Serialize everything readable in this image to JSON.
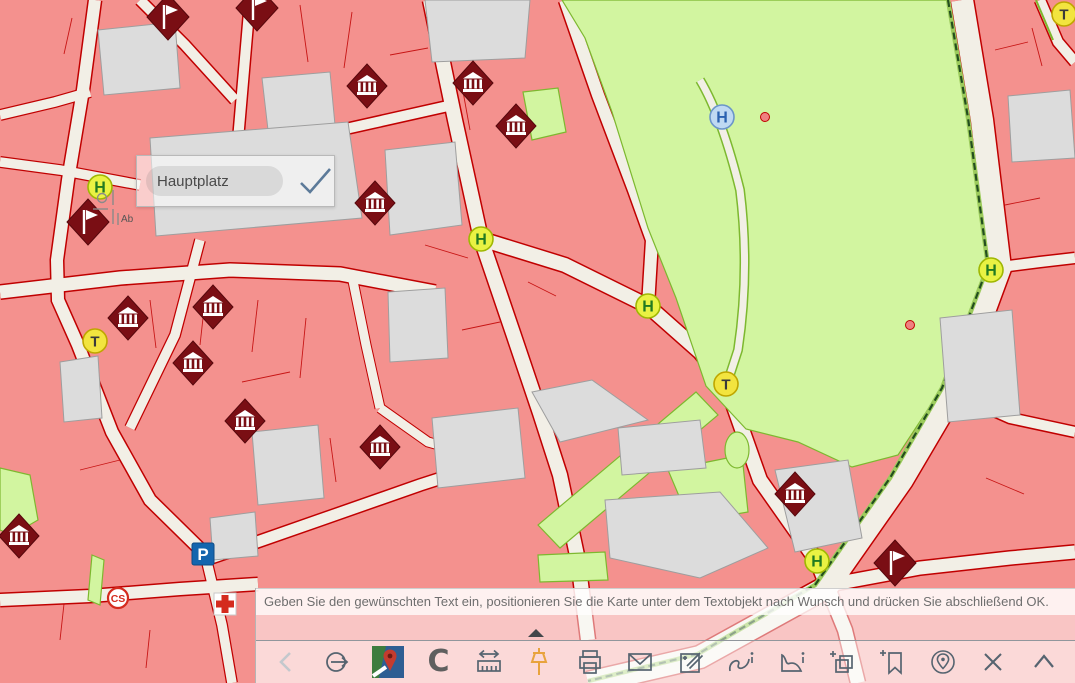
{
  "app": {
    "kind": "GIS map viewer with text annotation tool"
  },
  "text_overlay": {
    "value": "Hauptplatz",
    "confirm_icon": "check"
  },
  "message_bar": {
    "text": "Geben Sie den gewünschten Text ein, positionieren Sie die Karte unter dem Textobjekt nach Wunsch und drücken Sie abschließend OK."
  },
  "toolbar": {
    "items": [
      {
        "name": "back",
        "icon": "chevron-left",
        "label": ""
      },
      {
        "name": "sign-out",
        "icon": "arrow-circle",
        "label": ""
      },
      {
        "name": "basemap",
        "icon": "map-thumbnail",
        "label": ""
      },
      {
        "name": "copyright",
        "icon": "letter",
        "label": "C"
      },
      {
        "name": "measure",
        "icon": "ruler-arrows",
        "label": ""
      },
      {
        "name": "pin",
        "icon": "pushpin",
        "label": ""
      },
      {
        "name": "print",
        "icon": "printer",
        "label": ""
      },
      {
        "name": "email",
        "icon": "envelope",
        "label": ""
      },
      {
        "name": "edit",
        "icon": "edit-square",
        "label": ""
      },
      {
        "name": "line-info",
        "icon": "curve-info",
        "label": ""
      },
      {
        "name": "area-info",
        "icon": "polygon-info",
        "label": ""
      },
      {
        "name": "add-layers",
        "icon": "layers-plus",
        "label": ""
      },
      {
        "name": "add-bookmark",
        "icon": "bookmark-plus",
        "label": ""
      },
      {
        "name": "locate",
        "icon": "globe-pin",
        "label": ""
      },
      {
        "name": "close",
        "icon": "x",
        "label": ""
      },
      {
        "name": "collapse",
        "icon": "chevron-up",
        "label": ""
      }
    ]
  },
  "map": {
    "colors": {
      "street": "#F2EFE6",
      "building": "#F4918E",
      "building_border": "#C00000",
      "gray_building": "#DCDCDC",
      "park": "#D2F5A0",
      "park_border": "#7DB82F",
      "boundary_dash": "#234F1E",
      "marker_dark_red": "#7A0E14",
      "stop_yellow": "#E9F243",
      "taxi_yellow": "#F2E43F",
      "parking_blue": "#1465AE",
      "cross_red": "#D42B1E"
    },
    "markers": [
      {
        "type": "flag",
        "x": 168,
        "y": 17
      },
      {
        "type": "flag",
        "x": 257,
        "y": 8
      },
      {
        "type": "flag",
        "x": 88,
        "y": 222
      },
      {
        "type": "flag",
        "x": 895,
        "y": 563
      },
      {
        "type": "museum",
        "x": 367,
        "y": 86
      },
      {
        "type": "museum",
        "x": 473,
        "y": 83
      },
      {
        "type": "museum",
        "x": 516,
        "y": 126
      },
      {
        "type": "museum",
        "x": 375,
        "y": 203
      },
      {
        "type": "museum",
        "x": 128,
        "y": 318
      },
      {
        "type": "museum",
        "x": 213,
        "y": 307
      },
      {
        "type": "museum",
        "x": 193,
        "y": 363
      },
      {
        "type": "museum",
        "x": 245,
        "y": 421
      },
      {
        "type": "museum",
        "x": 380,
        "y": 447
      },
      {
        "type": "museum",
        "x": 19,
        "y": 536
      },
      {
        "type": "museum",
        "x": 795,
        "y": 494
      },
      {
        "type": "stop",
        "x": 100,
        "y": 187,
        "label": "H"
      },
      {
        "type": "stop",
        "x": 481,
        "y": 239,
        "label": "H"
      },
      {
        "type": "stop",
        "x": 648,
        "y": 306,
        "label": "H"
      },
      {
        "type": "stop",
        "x": 991,
        "y": 270,
        "label": "H"
      },
      {
        "type": "stop",
        "x": 817,
        "y": 561,
        "label": "H"
      },
      {
        "type": "stop_blue",
        "x": 722,
        "y": 117,
        "label": "H"
      },
      {
        "type": "taxi",
        "x": 95,
        "y": 341,
        "label": "T"
      },
      {
        "type": "taxi",
        "x": 726,
        "y": 384,
        "label": "T"
      },
      {
        "type": "taxi",
        "x": 1064,
        "y": 14,
        "label": "T"
      },
      {
        "type": "parking",
        "x": 203,
        "y": 554,
        "label": "P"
      },
      {
        "type": "first_aid",
        "x": 225,
        "y": 604
      },
      {
        "type": "carsharing",
        "x": 118,
        "y": 598,
        "label": "CS"
      },
      {
        "type": "dot",
        "x": 765,
        "y": 117
      },
      {
        "type": "dot",
        "x": 910,
        "y": 325
      },
      {
        "type": "survey_point",
        "x": 110,
        "y": 207,
        "label": "Ab"
      }
    ]
  }
}
